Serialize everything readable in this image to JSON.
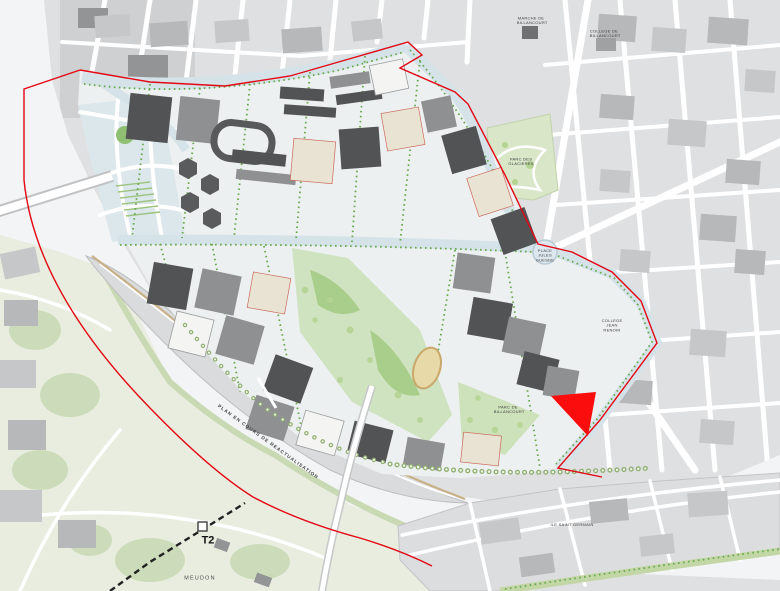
{
  "labels": {
    "plan_notice": "PLAN EN COURS DE REACTUALISATION",
    "tram_line": "T2",
    "city_meudon": "MEUDON",
    "parc_des_glacieres": "PARC DES GLACIERES",
    "parc_de_billancourt": "PARC DE BILLANCOURT",
    "place_jules_guesde": "PLACE JULES GUESDE",
    "college_jean_renoir": "COLLEGE JEAN RENOIR",
    "marche_de_billancourt": "MARCHE DE BILLANCOURT",
    "college_de_billancourt": "COLLEGE DE BILLANCOURT",
    "ile_saint_germain": "ILE SAINT GERMAIN"
  },
  "colors": {
    "boundary_red": "#e30613",
    "highlight_red": "#fb0d0d",
    "water": "#f3f4f5",
    "island_gray": "#dadbdc",
    "city_base": "#dfe0e1",
    "building_dark": "#525355",
    "building_mid": "#8f9092",
    "park_green": "#cfe3c0",
    "tree_green": "#69a84c",
    "avenue_blue": "#d5e3e9",
    "quay_tan": "#c8b086",
    "meudon_green": "#e9eddf"
  }
}
